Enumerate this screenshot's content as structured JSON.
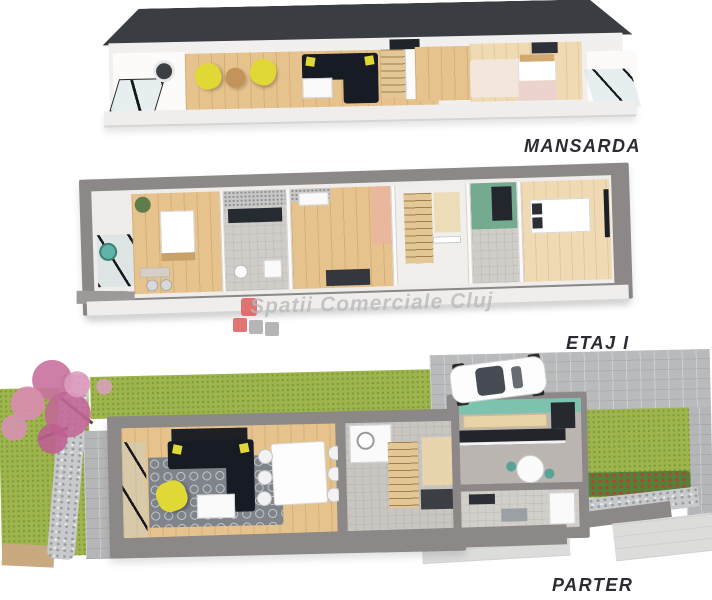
{
  "page": {
    "background": "#ffffff",
    "content_type": "3d-cutaway-floor-plans"
  },
  "floors": [
    {
      "id": "mansarda",
      "label": "MANSARDA"
    },
    {
      "id": "etaj1",
      "label": "ETAJ I"
    },
    {
      "id": "parter",
      "label": "PARTER"
    }
  ],
  "watermark": {
    "text": "Spatii Comerciale Cluj",
    "logo_red": "#e05c5c",
    "logo_gray": "#a9a9a9"
  },
  "palette": {
    "roof": "#3a3d42",
    "wall_gray": "#8b8887",
    "wood_floor": "#e6c28c",
    "grass_green": "#9db54c",
    "paving_gray": "#b4b6b8",
    "gabion_stone": "#c7c9cb",
    "sofa_navy": "#171b24",
    "accent_yellow": "#e0d935",
    "kitchen_teal": "#7cc2ae",
    "bath_green": "#74ab90",
    "tree_pink": "#c9719f",
    "rug_gray": "#7f838a",
    "label_text": "#2b2b33"
  }
}
